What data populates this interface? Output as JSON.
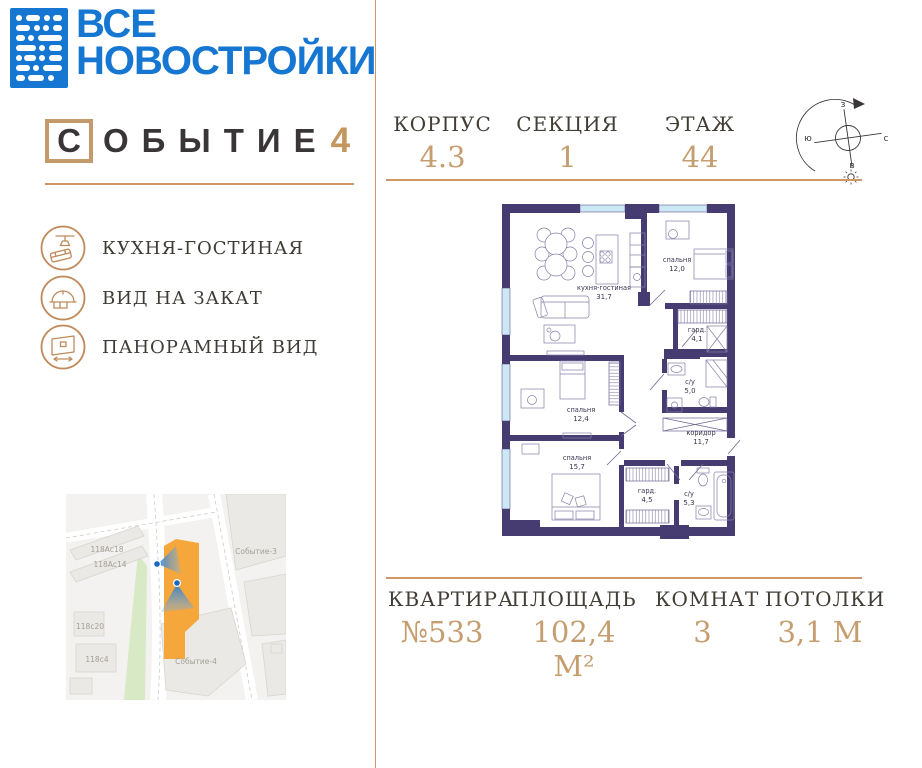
{
  "brand": {
    "logo_line1": "ВСЕ",
    "logo_line2": "НОВОСТРОЙКИ",
    "project_first_letter": "С",
    "project_rest": "ОБЫТИЕ",
    "project_number": "4"
  },
  "header": {
    "stats": [
      {
        "label": "КОРПУС",
        "value": "4.3"
      },
      {
        "label": "СЕКЦИЯ",
        "value": "1"
      },
      {
        "label": "ЭТАЖ",
        "value": "44"
      }
    ]
  },
  "compass": {
    "top": "з",
    "right": "с",
    "left": "ю",
    "bottom": "в"
  },
  "features": [
    {
      "icon": "kitchen-living-icon",
      "label": "КУХНЯ-ГОСТИНАЯ"
    },
    {
      "icon": "sunset-view-icon",
      "label": "ВИД НА ЗАКАТ"
    },
    {
      "icon": "panoramic-view-icon",
      "label": "ПАНОРАМНЫЙ ВИД"
    }
  ],
  "plan": {
    "rooms": [
      {
        "name": "кухня-гостиная",
        "area": "31,7"
      },
      {
        "name": "спальня",
        "area": "12,0"
      },
      {
        "name": "гард.",
        "area": "4,1"
      },
      {
        "name": "с/у",
        "area": "5,0"
      },
      {
        "name": "коридор",
        "area": "11,7"
      },
      {
        "name": "спальня",
        "area": "12,4"
      },
      {
        "name": "спальня",
        "area": "15,7"
      },
      {
        "name": "гард.",
        "area": "4,5"
      },
      {
        "name": "с/у",
        "area": "5,3"
      }
    ]
  },
  "map": {
    "labels": {
      "b1": "118Ас18",
      "b2": "118Ас14",
      "b3": "118с20",
      "b4": "118с4",
      "p3": "Событие-3",
      "p4": "Событие-4"
    }
  },
  "footer": {
    "stats": [
      {
        "label": "КВАРТИРА",
        "value": "№533"
      },
      {
        "label": "ПЛОЩАДЬ",
        "value": "102,4 М²"
      },
      {
        "label": "КОМНАТ",
        "value": "3"
      },
      {
        "label": "ПОТОЛКИ",
        "value": "3,1 М"
      }
    ]
  },
  "colors": {
    "accent": "#CE9765",
    "logo_blue": "#1677D2",
    "wall": "#463C72",
    "map_orange": "#F5A73B",
    "marker_blue": "#1C66BE",
    "text_dark": "#3E3931",
    "value_tan": "#C69D6F"
  }
}
